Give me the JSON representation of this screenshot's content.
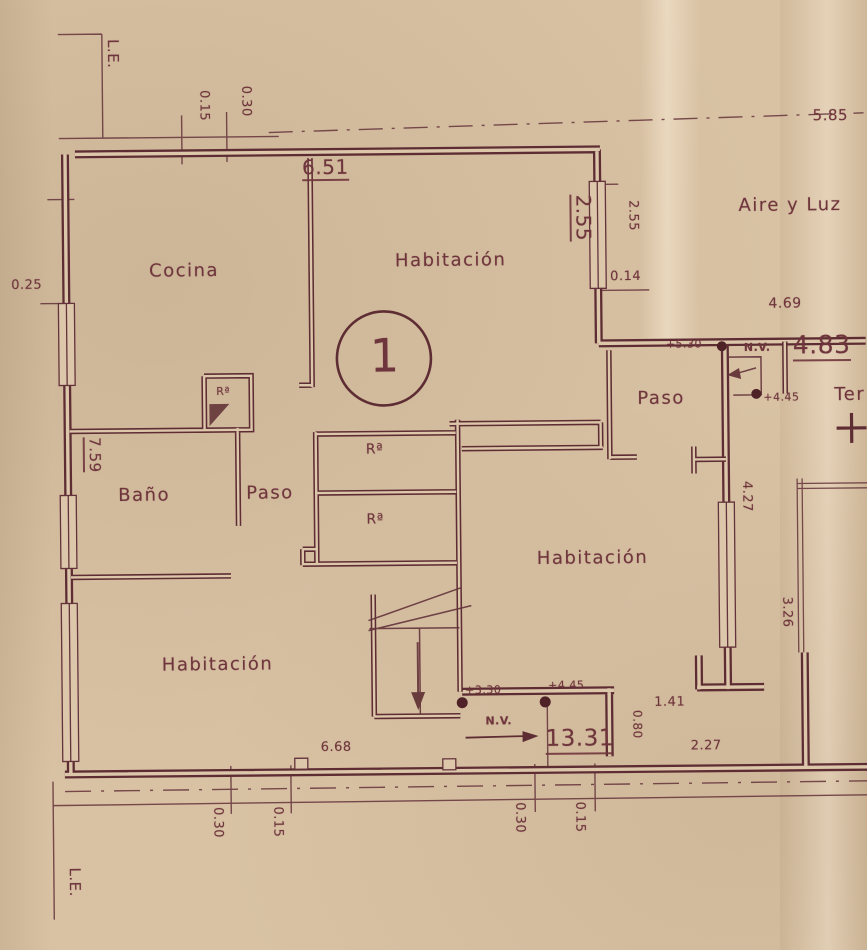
{
  "palette": {
    "paper": "#d9c2a4",
    "ink": "#5e2d33",
    "text": "#6f353c"
  },
  "labels": {
    "le": "L.E.",
    "nv": "N.V.",
    "unit": "1",
    "cocina": "Cocina",
    "habitacion": "Habitación",
    "bano": "Baño",
    "paso": "Paso",
    "closet": "Rª",
    "aire_y_luz": "Aire y Luz",
    "terraza": "Ter"
  },
  "dims": {
    "d015": "0.15",
    "d030": "0.30",
    "d025": "0.25",
    "d585": "5.85",
    "d651": "6.51",
    "d255": "2.55",
    "d014": "0.14",
    "d469": "4.69",
    "d483": "4.83",
    "d759": "7.59",
    "d427": "4.27",
    "d326": "3.26",
    "d141": "1.41",
    "d1331": "13.31",
    "d080": "0.80",
    "d227": "2.27",
    "d668": "6.68"
  },
  "levels": {
    "l530": "+5.30",
    "l445": "+4.45",
    "l330": "+3.30"
  }
}
